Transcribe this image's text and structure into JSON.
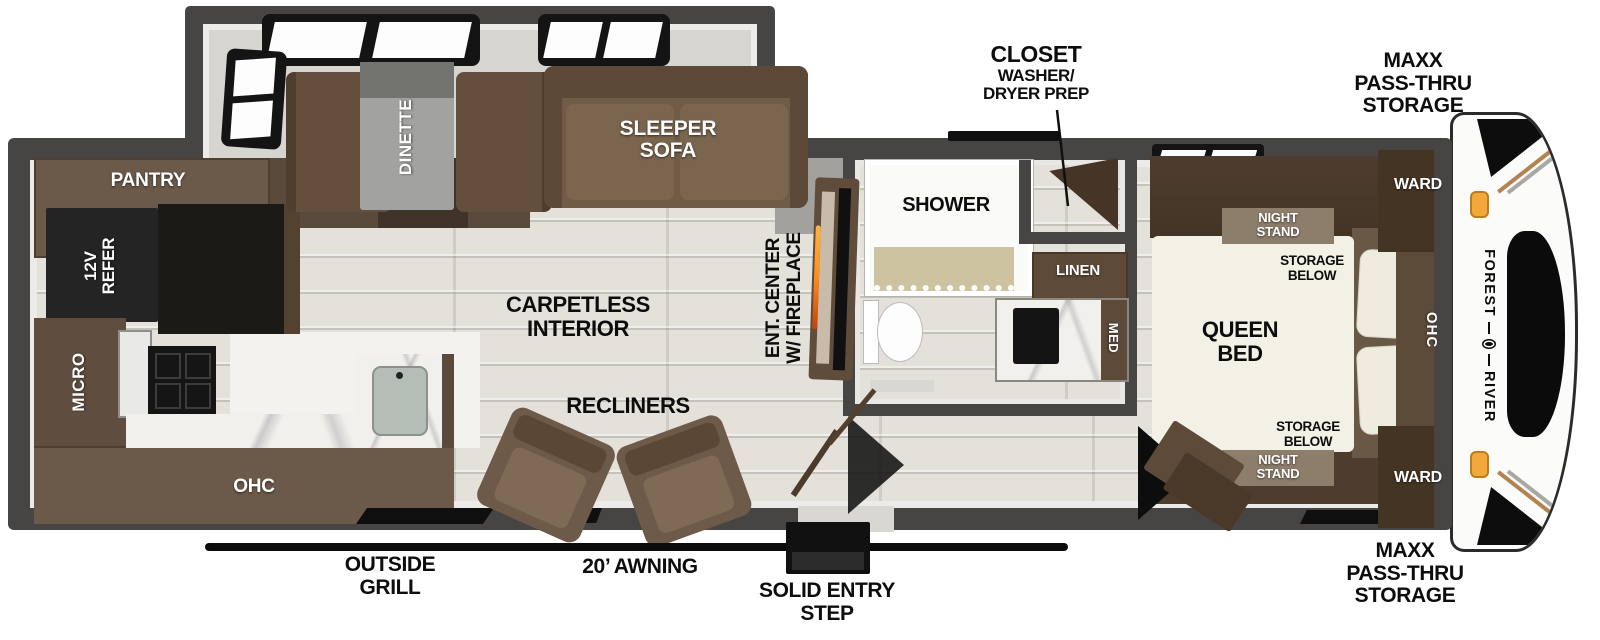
{
  "palette": {
    "wall": "#474544",
    "floor_gray": "#d9d7d2",
    "wood_floor": "#e3e1da",
    "cabinet_brown": "#6b5949",
    "cabinet_dark_brown": "#4a3a2c",
    "sofa_brown": "#6f5b46",
    "appliance_black": "#1c1a17",
    "mattress_cream": "#f3f0e5",
    "marble_white": "#f2f0ec",
    "amber_light": "#f2a93b",
    "fireplace_orange": "#ff8c1a"
  },
  "exterior": {
    "closet_callout": {
      "title": "CLOSET",
      "line2": "WASHER/",
      "line3": "DRYER PREP"
    },
    "front_storage_top": {
      "line1": "MAXX",
      "line2": "PASS-THRU",
      "line3": "STORAGE"
    },
    "front_storage_bottom": {
      "line1": "MAXX",
      "line2": "PASS-THRU",
      "line3": "STORAGE"
    },
    "outside_grill": {
      "line1": "OUTSIDE",
      "line2": "GRILL"
    },
    "awning_label": "20’ AWNING",
    "entry_step": {
      "line1": "SOLID ENTRY",
      "line2": "STEP"
    },
    "brand": {
      "word1": "FOREST",
      "word2": "RIVER"
    }
  },
  "kitchen": {
    "pantry": "PANTRY",
    "refer_line1": "12V",
    "refer_line2": "REFER",
    "micro": "MICRO",
    "ohc": "OHC"
  },
  "dining": {
    "dinette": "DINETTE",
    "sofa_line1": "SLEEPER",
    "sofa_line2": "SOFA"
  },
  "living": {
    "floor_line1": "CARPETLESS",
    "floor_line2": "INTERIOR",
    "recliners": "RECLINERS",
    "ent_line1": "ENT. CENTER",
    "ent_line2": "W/ FIREPLACE"
  },
  "bath": {
    "shower": "SHOWER",
    "linen": "LINEN",
    "med": "MED"
  },
  "bedroom": {
    "bed_line1": "QUEEN",
    "bed_line2": "BED",
    "night_top_line1": "NIGHT",
    "night_top_line2": "STAND",
    "night_bottom_line1": "NIGHT",
    "night_bottom_line2": "STAND",
    "storage_top_line1": "STORAGE",
    "storage_top_line2": "BELOW",
    "storage_bottom_line1": "STORAGE",
    "storage_bottom_line2": "BELOW",
    "ward_top": "WARD",
    "ward_bottom": "WARD",
    "ohc": "OHC"
  }
}
